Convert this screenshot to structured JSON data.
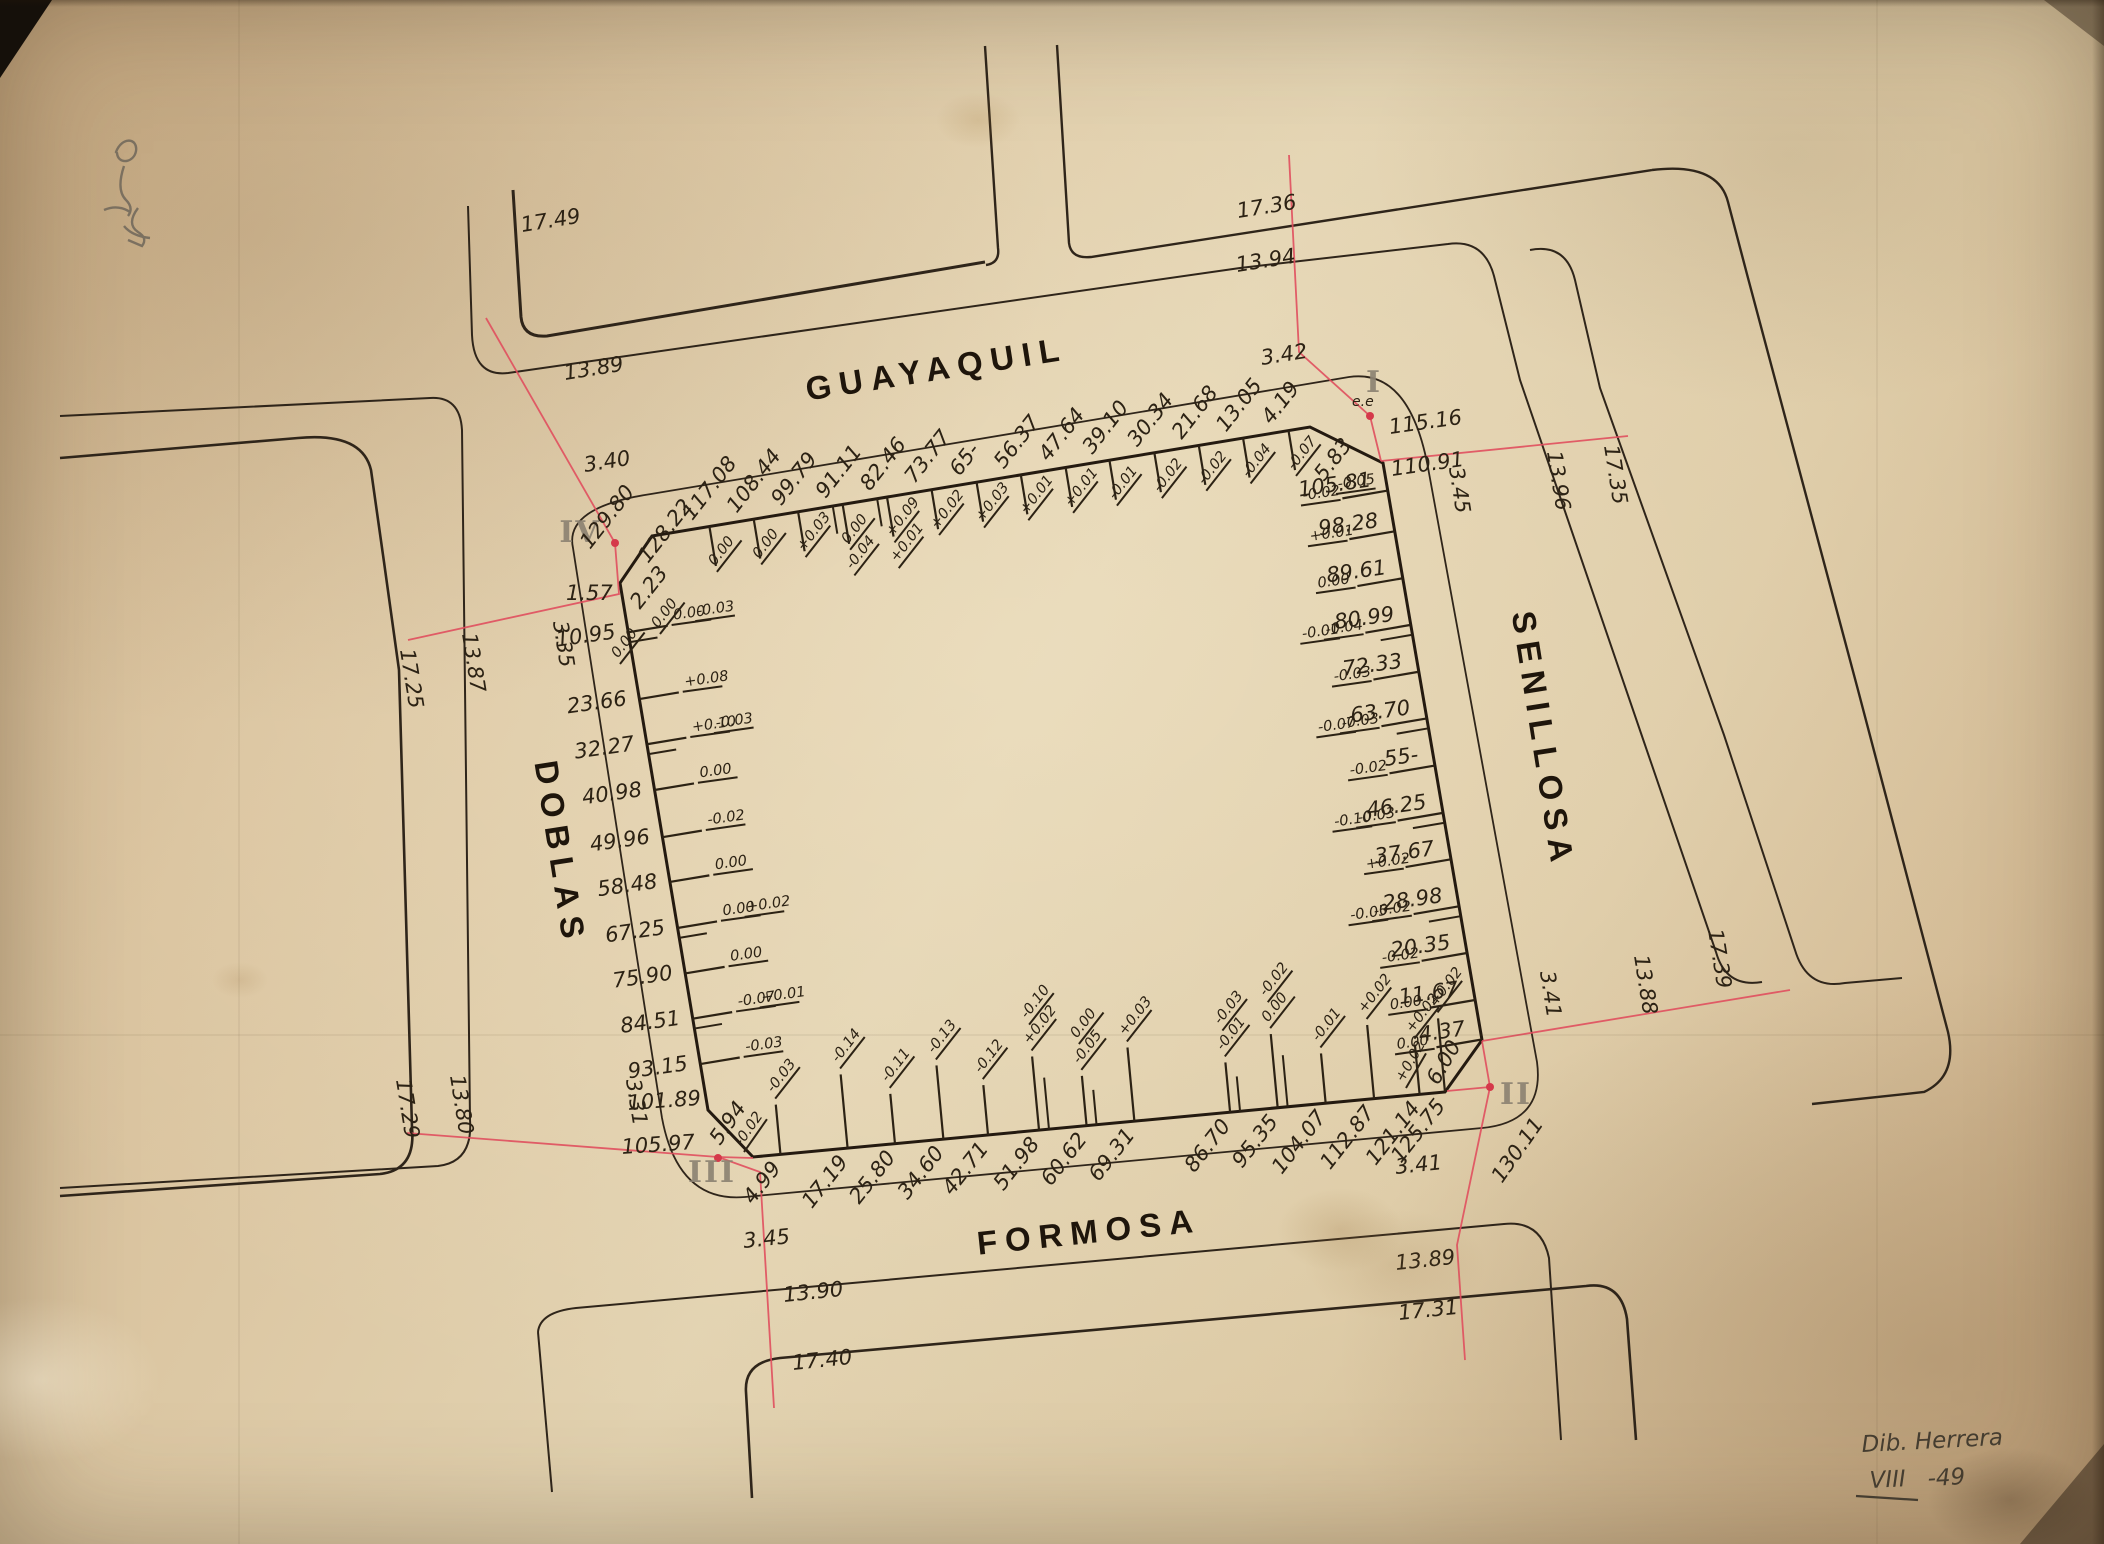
{
  "streets": {
    "top": "GUAYAQUIL",
    "right": "SENILLOSA",
    "bottom": "FORMOSA",
    "left": "DOBLAS"
  },
  "signature": {
    "line1": "Dib. Herrera",
    "roman": "VIII",
    "year": "-49"
  },
  "corners": {
    "I": {
      "numeral": "I",
      "note": "e.e",
      "dot_label": "115.16",
      "corner_label": "110.91",
      "chamfer_len": "5.83",
      "chamfer_corrs": [
        "-0.05"
      ]
    },
    "II": {
      "numeral": "II",
      "dot_label": "130.11",
      "chamfer_len": "6.00",
      "chamfer_corrs": [
        "+0.02"
      ]
    },
    "III": {
      "numeral": "III",
      "dot_label": "105.97",
      "corner_label": "101.89",
      "chamfer_len": "5.94",
      "chamfer_corrs": [
        "-0.02"
      ]
    },
    "IV": {
      "numeral": "IV",
      "dot_label": "129.80",
      "corner_label": "128.22",
      "chamfer_len": "2.23",
      "chamfer_corrs": [
        "0.00",
        "0.00"
      ]
    }
  },
  "intersections": {
    "top_left": {
      "guayaquil": {
        "far": "17.49",
        "mid": "13.89",
        "near": "3.40"
      },
      "doblas": {
        "far": "17.25",
        "mid": "13.87",
        "near": "3.35"
      },
      "offset": "1.57"
    },
    "top_right": {
      "guayaquil": {
        "far": "17.36",
        "mid": "13.94",
        "near": "3.42"
      },
      "senillosa": {
        "far": "17.35",
        "mid": "13.96",
        "near": "3.45"
      }
    },
    "bottom_right": {
      "senillosa": {
        "far": "17.39",
        "mid": "13.88",
        "near": "3.41"
      },
      "formosa": {
        "far": "17.31",
        "mid": "13.89",
        "near": "3.41"
      }
    },
    "bottom_left": {
      "doblas": {
        "far": "17.29",
        "mid": "13.80",
        "near": "3.31"
      },
      "formosa": {
        "far": "17.40",
        "mid": "13.90",
        "near": "3.45"
      }
    }
  },
  "edges": {
    "top": {
      "marks": [
        {
          "d": "4.19",
          "c": [
            "-0.07"
          ]
        },
        {
          "d": "13.05",
          "c": [
            "-0.04"
          ]
        },
        {
          "d": "21.68",
          "c": [
            "-0.02"
          ]
        },
        {
          "d": "30.34",
          "c": [
            "-0.02"
          ]
        },
        {
          "d": "39.10",
          "c": [
            "-0.01"
          ]
        },
        {
          "d": "47.64",
          "c": [
            "+0.01"
          ]
        },
        {
          "d": "56.37",
          "c": [
            "+0.01"
          ]
        },
        {
          "d": "65-",
          "c": [
            "+0.03"
          ]
        },
        {
          "d": "73.77",
          "c": [
            "+0.02"
          ]
        },
        {
          "d": "82.46",
          "c": [
            "+0.09",
            "+0.01"
          ]
        },
        {
          "d": "91.11",
          "c": [
            "0.00",
            "-0.04"
          ]
        },
        {
          "d": "99.79",
          "c": [
            "+0.03"
          ]
        },
        {
          "d": "108.44",
          "c": [
            "0.00"
          ]
        },
        {
          "d": "117.08",
          "c": [
            "0.00"
          ]
        }
      ]
    },
    "right": {
      "marks": [
        {
          "d": "105.81",
          "c": [
            "-0.02"
          ]
        },
        {
          "d": "98.28",
          "c": [
            "+0.01"
          ]
        },
        {
          "d": "89.61",
          "c": [
            "0.00"
          ]
        },
        {
          "d": "80.99",
          "c": [
            "-0.04",
            "-0.01"
          ]
        },
        {
          "d": "72.33",
          "c": [
            "-0.03"
          ]
        },
        {
          "d": "63.70",
          "c": [
            "-0.03",
            "-0.07"
          ]
        },
        {
          "d": "55-",
          "c": [
            "-0.02"
          ]
        },
        {
          "d": "46.25",
          "c": [
            "-0.03",
            "-0.10"
          ]
        },
        {
          "d": "37.67",
          "c": [
            "+0.02"
          ]
        },
        {
          "d": "28.98",
          "c": [
            "-0.02",
            "-0.05"
          ]
        },
        {
          "d": "20.35",
          "c": [
            "-0.02"
          ]
        },
        {
          "d": "11.67",
          "c": [
            "0.00"
          ]
        },
        {
          "d": "4.37",
          "c": [
            "0.00"
          ]
        }
      ]
    },
    "bottom": {
      "marks": [
        {
          "d": "4.99",
          "c": [
            "-0.03"
          ]
        },
        {
          "d": "17.19",
          "c": [
            "-0.14"
          ]
        },
        {
          "d": "25.80",
          "c": [
            "-0.11"
          ]
        },
        {
          "d": "34.60",
          "c": [
            "-0.13"
          ]
        },
        {
          "d": "42.71",
          "c": [
            "-0.12"
          ]
        },
        {
          "d": "51.98",
          "c": [
            "+0.02",
            "-0.10"
          ]
        },
        {
          "d": "60.62",
          "c": [
            "-0.05",
            "0.00"
          ]
        },
        {
          "d": "69.31",
          "c": [
            "+0.03"
          ]
        },
        {
          "d": "86.70",
          "c": [
            "-0.01",
            "-0.03"
          ]
        },
        {
          "d": "95.35",
          "c": [
            "0.00",
            "-0.02"
          ]
        },
        {
          "d": "104.07",
          "c": [
            "-0.01"
          ]
        },
        {
          "d": "112.87",
          "c": [
            "+0.02"
          ]
        },
        {
          "d": "121.14",
          "c": [
            "+0.02"
          ]
        },
        {
          "d": "125.75",
          "c": [
            "+0.02"
          ]
        }
      ]
    },
    "left": {
      "marks": [
        {
          "d": "10.95",
          "c": [
            "0.00",
            "-0.03"
          ]
        },
        {
          "d": "23.66",
          "c": [
            "+0.08"
          ]
        },
        {
          "d": "32.27",
          "c": [
            "+0.10",
            "-0.03"
          ]
        },
        {
          "d": "40.98",
          "c": [
            "0.00"
          ]
        },
        {
          "d": "49.96",
          "c": [
            "-0.02"
          ]
        },
        {
          "d": "58.48",
          "c": [
            "0.00"
          ]
        },
        {
          "d": "67.25",
          "c": [
            "0.00",
            "+0.02"
          ]
        },
        {
          "d": "75.90",
          "c": [
            "0.00"
          ]
        },
        {
          "d": "84.51",
          "c": [
            "-0.07",
            "+0.01"
          ]
        },
        {
          "d": "93.15",
          "c": [
            "-0.03"
          ]
        }
      ]
    }
  }
}
